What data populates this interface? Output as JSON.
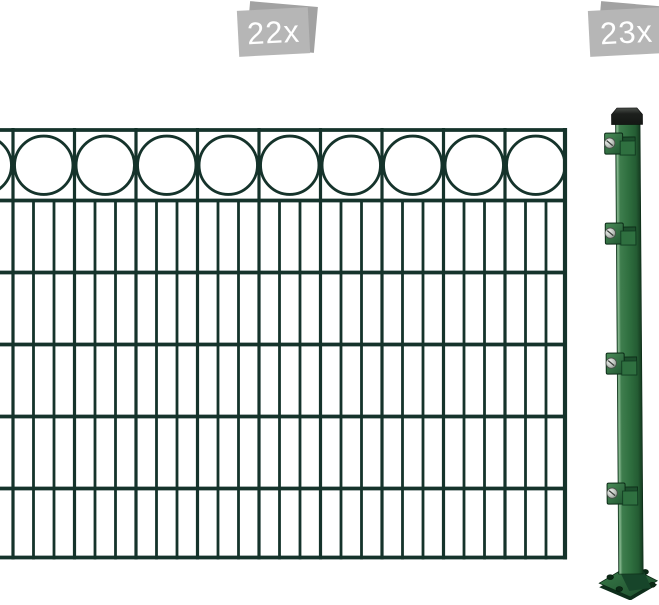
{
  "badges": {
    "panel_quantity_badge": {
      "label": "22x"
    },
    "post_quantity_badge": {
      "label": "23x"
    }
  },
  "colors": {
    "background": "#ffffff",
    "fence_wire": "#15332b",
    "post_green": "#2f6f3f",
    "post_green_highlight": "#8ab992",
    "post_green_dark": "#153a20",
    "post_cap": "#141714",
    "bracket_green": "#2f7040",
    "bracket_screw": "#b9bfb9",
    "badge_front": "#b6b6b6",
    "badge_back": "#a2a2a2",
    "badge_text": "#ffffff"
  }
}
